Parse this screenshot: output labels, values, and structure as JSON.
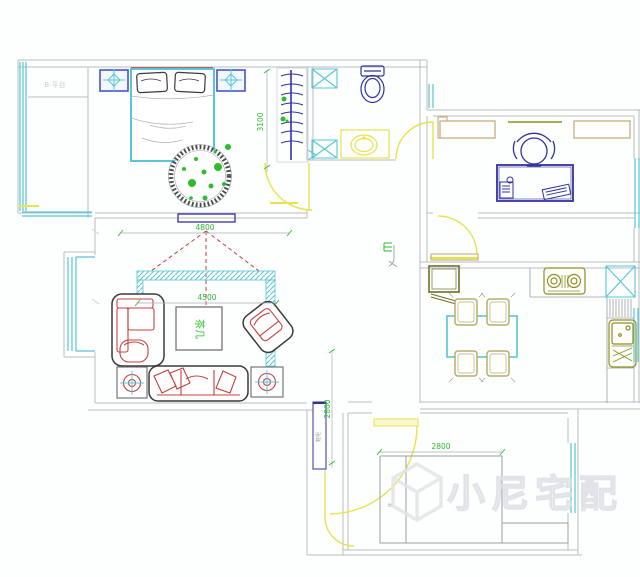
{
  "labels": {
    "balcony": "B-平台",
    "coffee_table": "茶几",
    "shoe_cabinet": "鞋柜",
    "bed_small": "床",
    "watermark": "小尼宅配"
  },
  "dimensions": {
    "bedroom_depth": "3100",
    "living_width_top": "4800",
    "living_width_sofa": "4500",
    "entry_height": "2800",
    "bedroom2_width": "2800"
  },
  "colors": {
    "wall": "#b7bdc3",
    "wall_light": "#cdd2d6",
    "window": "#58c6d4",
    "fixture_blue": "#31319e",
    "nightstand_blue": "#4656c8",
    "red": "#c44040",
    "green": "#2ebd2e",
    "yellow": "#e7e34c",
    "olive": "#8f8f1e",
    "olive_dark": "#6f6f2a",
    "tan": "#c9ad7c",
    "chair_tan": "#b5ae6a",
    "outline": "#3a3a3a",
    "gray_detail": "#9aa0a6",
    "sheet_gray": "#b0b4b8",
    "dim_line": "#a9b0b6",
    "watermark": "#e3e5e8",
    "watermark_fill": "#f0f1f3",
    "faint_label": "#c9ccd2"
  }
}
